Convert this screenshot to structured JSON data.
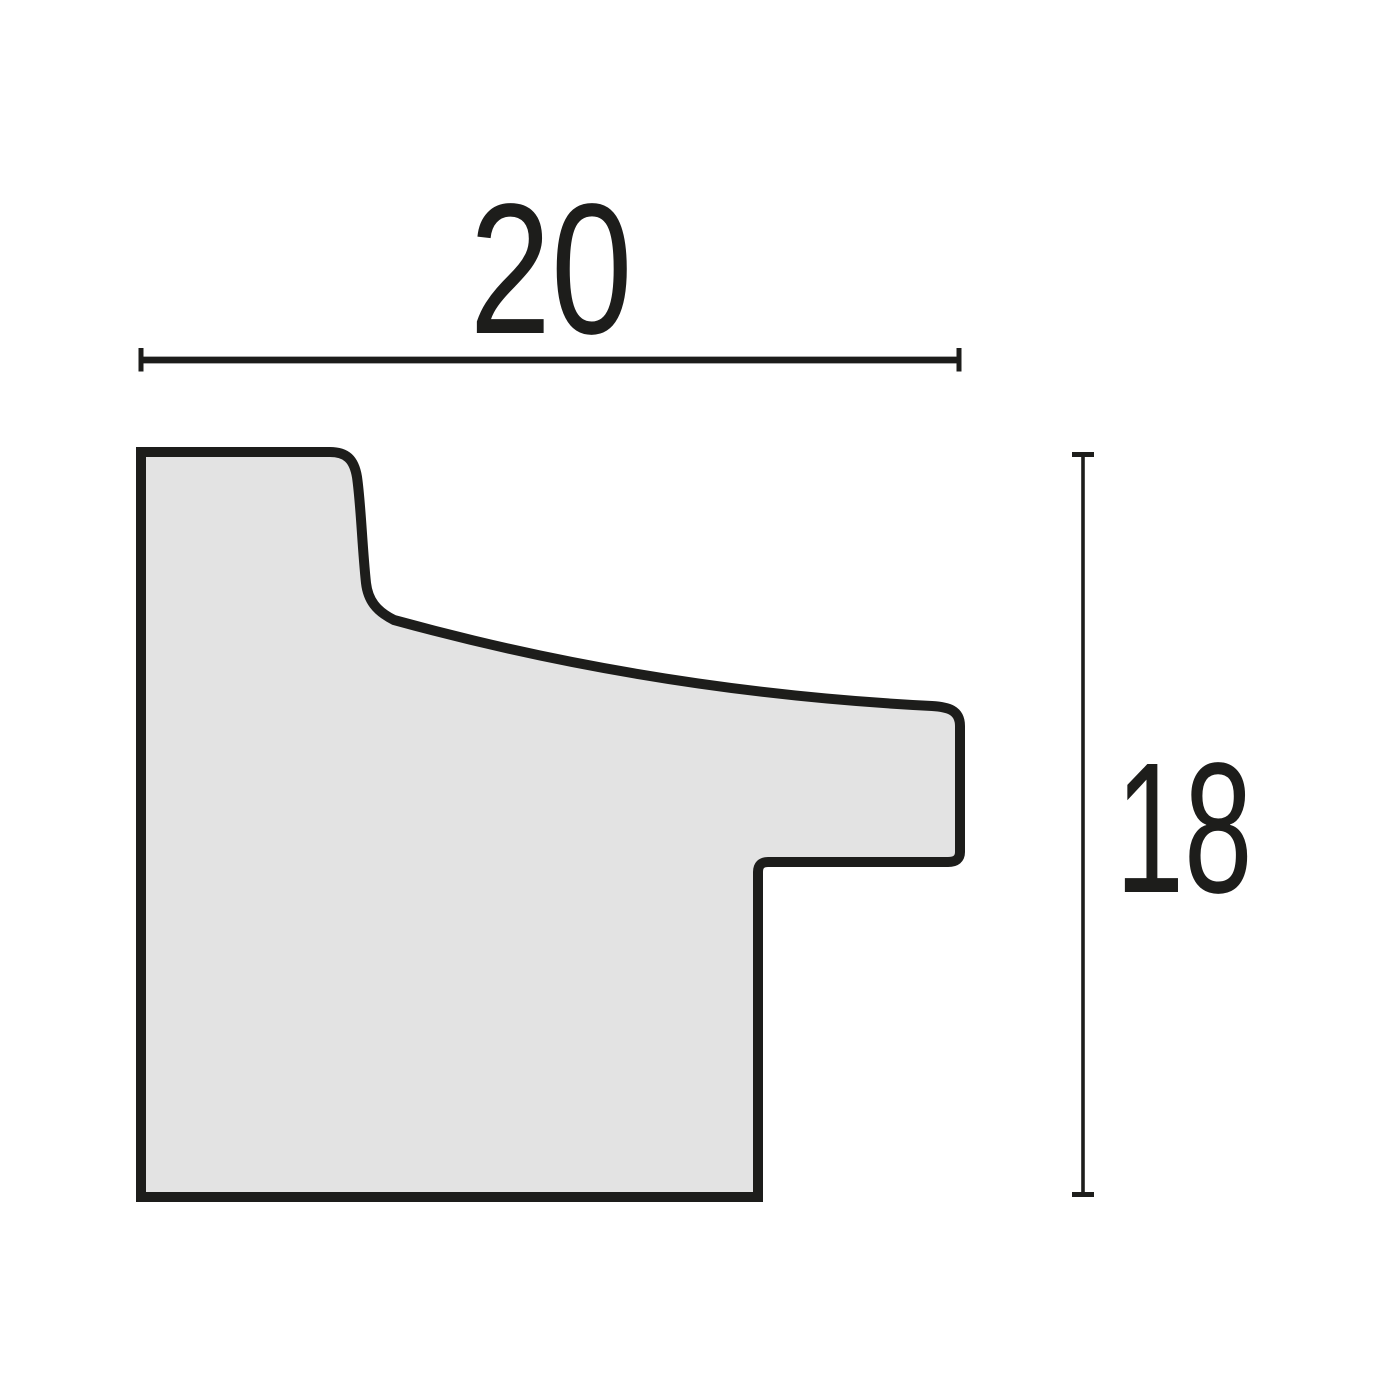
{
  "diagram": {
    "title": "Frame moulding profile cross-section with dimensions",
    "width_dimension": {
      "label": "20",
      "orientation": "horizontal",
      "position": "top"
    },
    "height_dimension": {
      "label": "18",
      "orientation": "vertical",
      "position": "right"
    },
    "colors": {
      "outline": "#1d1d1b",
      "profile_fill": "#e3e3e3",
      "background": "#ffffff",
      "text": "#1d1d1b"
    }
  }
}
